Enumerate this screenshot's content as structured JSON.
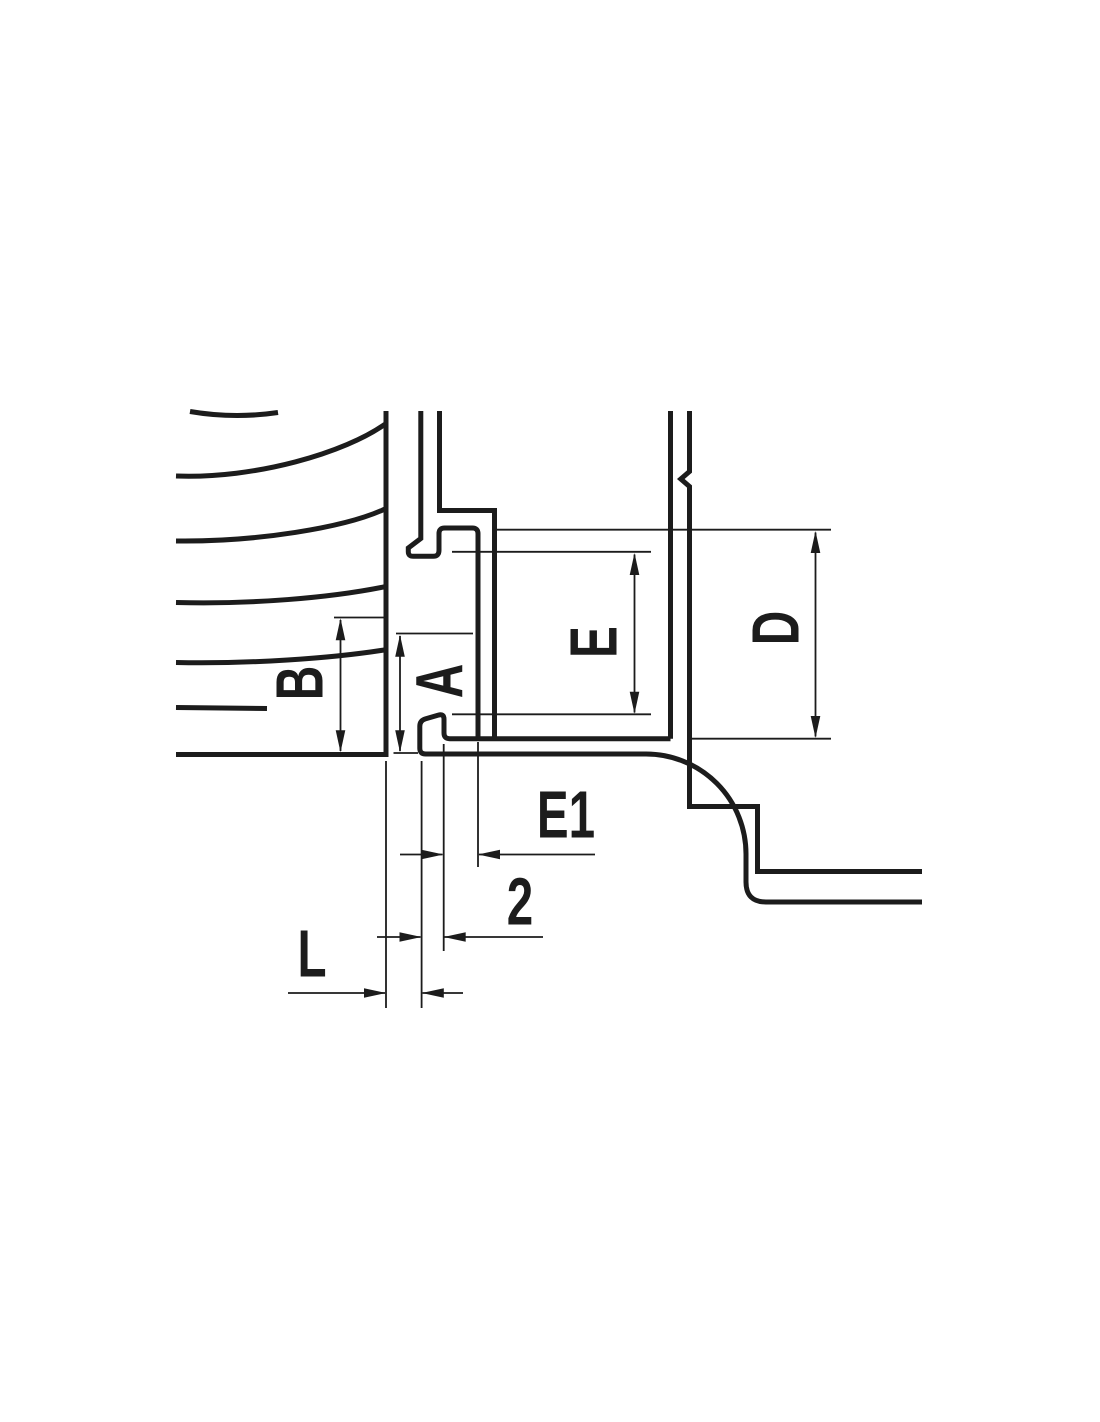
{
  "drawing": {
    "type": "mechanical-section-dimension-drawing",
    "dimension_labels": {
      "b": "B",
      "a": "A",
      "e": "E",
      "d": "D",
      "e1": "E1",
      "two": "2",
      "l": "L"
    }
  },
  "colors": {
    "line": "#1c1c1c",
    "background": "#ffffff"
  }
}
